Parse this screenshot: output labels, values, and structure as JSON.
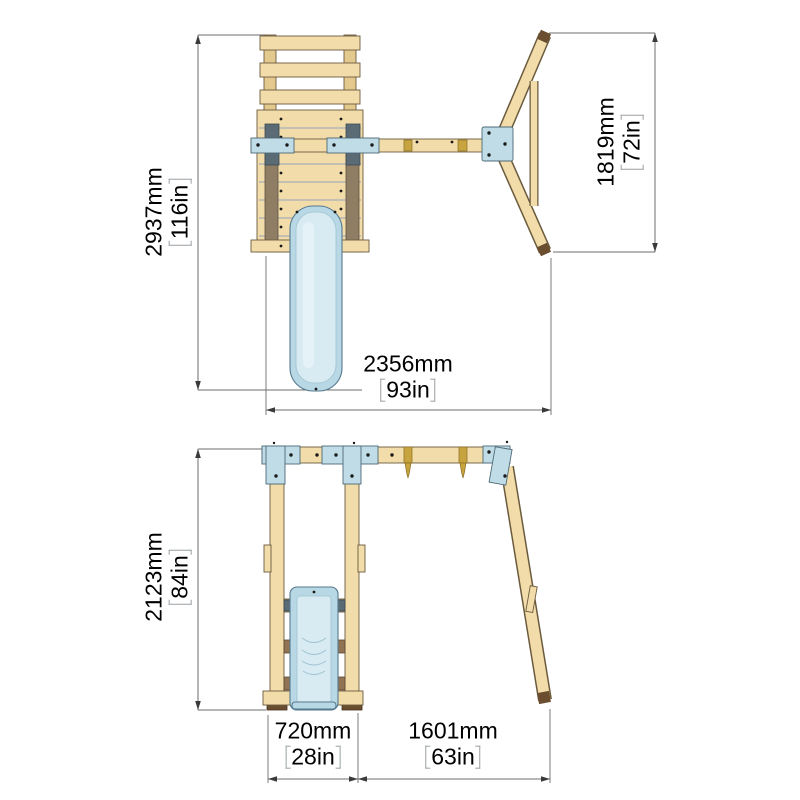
{
  "colors": {
    "dim_line": "#6e6e6e",
    "dim_arrow": "#3a3a3a",
    "wood_light": "#F2DCA9",
    "wood_mid": "#E4C98F",
    "wood_outline": "#6B5B3E",
    "wood_dark_post": "#8F7E64",
    "rail_brown": "#8F7353",
    "bracket_blue": "#BFDCE7",
    "bracket_outline": "#4E6A77",
    "slate": "#5B6B76",
    "slide_blue": "#B9D8E5",
    "slide_blue_light": "#D8EBF3",
    "slide_outline": "#557A8E",
    "slide_mid": "#9FC2D2",
    "gold": "#C8A440",
    "gold_dark": "#8A6D22",
    "bolt": "#1a1a1a",
    "foot_brown": "#6B4E2F",
    "bracket_text": "#9aa0a3"
  },
  "plan_view": {
    "depth": {
      "mm": "2937mm",
      "in": "116in"
    },
    "spread": {
      "mm": "1819mm",
      "in": "72in"
    },
    "width": {
      "mm": "2356mm",
      "in": "93in"
    }
  },
  "front_view": {
    "height": {
      "mm": "2123mm",
      "in": "84in"
    },
    "tower_width": {
      "mm": "720mm",
      "in": "28in"
    },
    "swing_bay_width": {
      "mm": "1601mm",
      "in": "63in"
    }
  }
}
